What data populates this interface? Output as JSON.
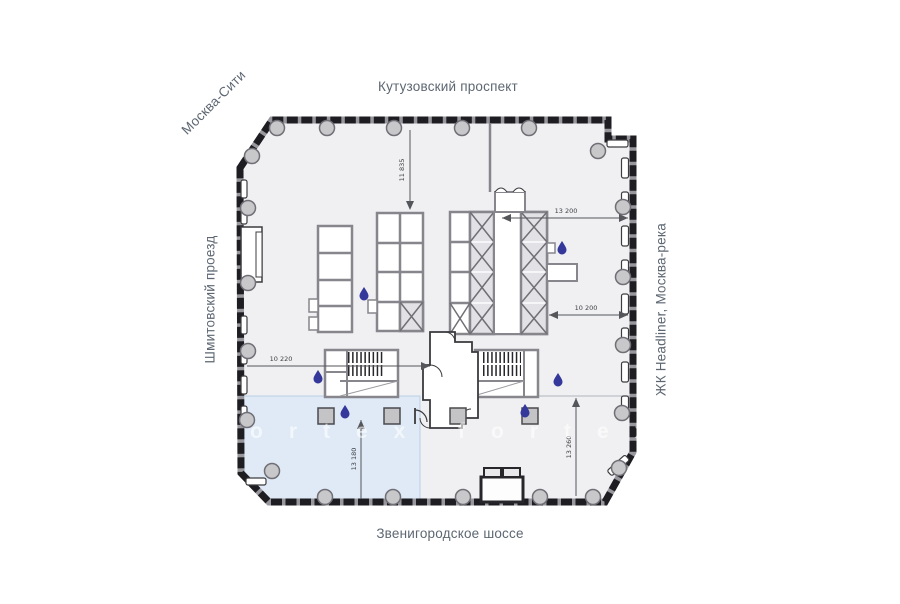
{
  "streets": {
    "top": "Кутузовский проспект",
    "top_left": "Москва-Сити",
    "left": "Шмитовский проезд",
    "right": "ЖК Headliner, Москва-река",
    "bottom": "Звенигородское шоссе"
  },
  "dimensions": {
    "upper_vertical": "11 835",
    "right_upper": "13 200",
    "right_mid": "10 200",
    "left_mid": "10 220",
    "bottom_left_vertical": "13 180",
    "bottom_right_vertical": "13 260"
  },
  "watermark": {
    "left": "ortex",
    "right": "fortex"
  },
  "colors": {
    "floor": "#f0f0f2",
    "highlight_zone": "#dfeaf6",
    "highlight_border": "#b9cfe4",
    "wall_dark": "#1d1d22",
    "wall_base": "#97979d",
    "wall_interior": "#86868c",
    "column_fill": "#c8c8cb",
    "column_border": "#6f6f75",
    "street_label": "#5d6772",
    "water_drop": "#34389b",
    "x_cell_fill": "#e2e2e6"
  }
}
